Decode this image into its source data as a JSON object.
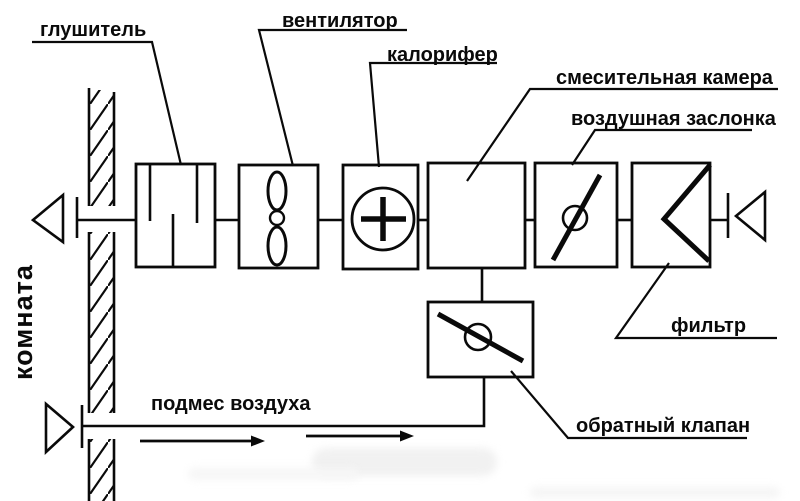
{
  "colors": {
    "line": "#000000",
    "background": "#ffffff",
    "watermark": "#f1f1f1"
  },
  "labels": {
    "silencer": "глушитель",
    "fan": "вентилятор",
    "heater": "калорифер",
    "mixing_chamber": "смесительная камера",
    "air_damper": "воздушная заслонка",
    "filter": "фильтр",
    "check_valve": "обратный клапан",
    "air_admix": "подмес воздуха",
    "room": "комната"
  }
}
